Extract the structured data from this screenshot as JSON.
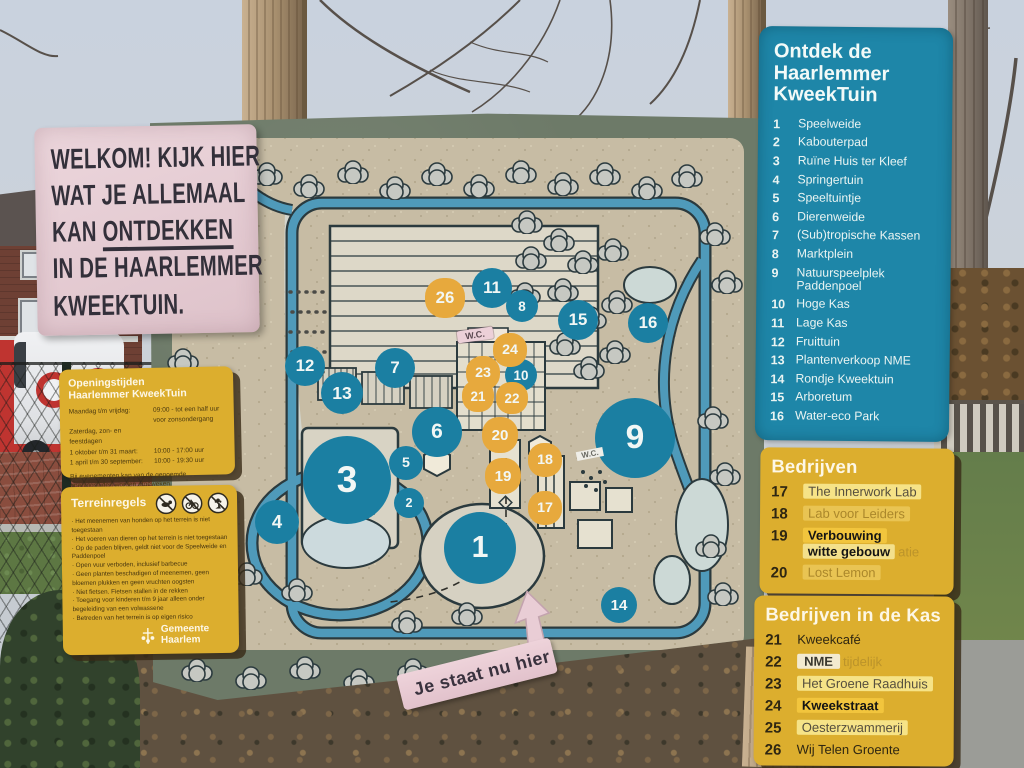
{
  "colors": {
    "sky": "#c9d2de",
    "board": "#6d7a68",
    "map_beige": "#c7bca4",
    "canal": "#4f9aba",
    "marker_blue": "#1b7fa2",
    "marker_yellow": "#e7a93d",
    "panel_blue": "#1e86a8",
    "panel_yellow": "#dcae2e",
    "sign_pink": "#e6ccd3",
    "wood": "#a8906f",
    "grass": "#5d7743",
    "path": "#9b9c97",
    "ground": "#5f5140",
    "brick_road": "#8a4d3e",
    "hedge": "#6b5132",
    "van_red": "#bf3430"
  },
  "welcome_sign": {
    "line1": "WELKOM! KIJK HIER",
    "line2": "WAT JE ALLEMAAL",
    "line3_prefix": "KAN ",
    "line3_underlined": "ONTDEKKEN",
    "line4": "IN DE HAARLEMMER",
    "line5": "KWEEKTUIN."
  },
  "opening_panel": {
    "title_line1": "Openingstijden",
    "title_line2": "Haarlemmer KweekTuin",
    "rows": [
      {
        "label": "Maandag t/m vrijdag:",
        "value": "09:00 - tot een half uur voor zonsondergang"
      },
      {
        "label": "Zaterdag, zon- en feestdagen",
        "value": ""
      },
      {
        "label": "1 oktober t/m 31 maart:",
        "value": "10:00 - 17:00 uur"
      },
      {
        "label": "1 april t/m 30 september:",
        "value": "10:00 - 19:30 uur"
      }
    ],
    "footnote": "Bij evenementen kan van de genoemde openingstijden worden afgeweken."
  },
  "rules_panel": {
    "title": "Terreinregels",
    "rules": [
      "Het meenemen van honden op het terrein is niet toegestaan",
      "Het voeren van dieren op het terrein is niet toegestaan",
      "Op de paden blijven, geldt niet voor de Speelweide en Paddenpoel",
      "Open vuur verboden, inclusief barbecue",
      "Geen planten beschadigen of meenemen, geen bloemen plukken en geen vruchten oogsten",
      "Niet fietsen. Fietsen stallen in de rekken",
      "Toegang voor kinderen t/m 9 jaar alleen onder begeleiding van een volwassene",
      "Betreden van het terrein is op eigen risico"
    ],
    "logo_text": "Gemeente Haarlem"
  },
  "legend_panel": {
    "title_line1": "Ontdek de",
    "title_line2": "Haarlemmer",
    "title_line3": "KweekTuin",
    "items": [
      {
        "num": "1",
        "label": "Speelweide"
      },
      {
        "num": "2",
        "label": "Kabouterpad"
      },
      {
        "num": "3",
        "label": "Ruïne Huis ter Kleef"
      },
      {
        "num": "4",
        "label": "Springertuin"
      },
      {
        "num": "5",
        "label": "Speeltuintje"
      },
      {
        "num": "6",
        "label": "Dierenweide"
      },
      {
        "num": "7",
        "label": "(Sub)tropische Kassen"
      },
      {
        "num": "8",
        "label": "Marktplein"
      },
      {
        "num": "9",
        "label": "Natuurspeelplek Paddenpoel"
      },
      {
        "num": "10",
        "label": "Hoge Kas"
      },
      {
        "num": "11",
        "label": "Lage Kas"
      },
      {
        "num": "12",
        "label": "Fruittuin"
      },
      {
        "num": "13",
        "label": "Plantenverkoop NME"
      },
      {
        "num": "14",
        "label": "Rondje Kweektuin"
      },
      {
        "num": "15",
        "label": "Arboretum"
      },
      {
        "num": "16",
        "label": "Water-eco Park"
      }
    ]
  },
  "bedrijven_panel": {
    "title": "Bedrijven",
    "items": [
      {
        "num": "17",
        "label": "The Innerwork Lab",
        "style": "sticker"
      },
      {
        "num": "18",
        "label": "Lab voor Leiders",
        "style": "faded"
      },
      {
        "num": "19",
        "label": "Verbouwing",
        "label2": "witte gebouw",
        "ghost2": "atie",
        "style": "sticker-dark"
      },
      {
        "num": "20",
        "label": "Lost Lemon",
        "style": "faded"
      }
    ]
  },
  "kas_panel": {
    "title": "Bedrijven in de Kas",
    "items": [
      {
        "num": "21",
        "label": "Kweekcafé",
        "style": "plain"
      },
      {
        "num": "22",
        "label": "NME",
        "ghost": "tijdelijk",
        "style": "sticker-white"
      },
      {
        "num": "23",
        "label": "Het Groene Raadhuis",
        "style": "sticker"
      },
      {
        "num": "24",
        "label": "Kweekstraat",
        "style": "sticker-dark"
      },
      {
        "num": "25",
        "label": "Oesterzwammerij",
        "style": "sticker"
      },
      {
        "num": "26",
        "label": "Wij Telen Groente",
        "style": "plain"
      }
    ]
  },
  "map": {
    "you_are_here": "Je staat nu hier",
    "labels": [
      {
        "text": "W.C.",
        "x": 325,
        "y": 225,
        "style": "ribbon"
      },
      {
        "text": "W.C.",
        "x": 440,
        "y": 344,
        "style": "tag"
      }
    ],
    "markers": [
      {
        "num": "1",
        "color": "blue",
        "x": 330,
        "y": 438,
        "size": 72
      },
      {
        "num": "2",
        "color": "blue",
        "x": 259,
        "y": 393,
        "size": 30
      },
      {
        "num": "3",
        "color": "blue",
        "x": 197,
        "y": 370,
        "size": 88
      },
      {
        "num": "4",
        "color": "blue",
        "x": 127,
        "y": 412,
        "size": 44
      },
      {
        "num": "5",
        "color": "blue",
        "x": 256,
        "y": 353,
        "size": 34
      },
      {
        "num": "6",
        "color": "blue",
        "x": 287,
        "y": 322,
        "size": 50
      },
      {
        "num": "7",
        "color": "blue",
        "x": 245,
        "y": 258,
        "size": 40
      },
      {
        "num": "8",
        "color": "blue",
        "x": 372,
        "y": 196,
        "size": 32
      },
      {
        "num": "9",
        "color": "blue",
        "x": 485,
        "y": 328,
        "size": 80
      },
      {
        "num": "10",
        "color": "blue",
        "x": 371,
        "y": 265,
        "size": 32
      },
      {
        "num": "11",
        "color": "blue",
        "x": 342,
        "y": 178,
        "size": 40
      },
      {
        "num": "12",
        "color": "blue",
        "x": 155,
        "y": 256,
        "size": 40
      },
      {
        "num": "13",
        "color": "blue",
        "x": 192,
        "y": 283,
        "size": 42
      },
      {
        "num": "14",
        "color": "blue",
        "x": 469,
        "y": 495,
        "size": 36
      },
      {
        "num": "15",
        "color": "blue",
        "x": 428,
        "y": 210,
        "size": 40
      },
      {
        "num": "16",
        "color": "blue",
        "x": 498,
        "y": 213,
        "size": 40
      },
      {
        "num": "17",
        "color": "yellow",
        "x": 395,
        "y": 398,
        "size": 34
      },
      {
        "num": "18",
        "color": "yellow",
        "x": 395,
        "y": 350,
        "size": 34
      },
      {
        "num": "19",
        "color": "yellow",
        "x": 353,
        "y": 366,
        "size": 36
      },
      {
        "num": "20",
        "color": "yellow",
        "x": 350,
        "y": 325,
        "size": 36
      },
      {
        "num": "21",
        "color": "yellow",
        "x": 328,
        "y": 286,
        "size": 32
      },
      {
        "num": "22",
        "color": "yellow",
        "x": 362,
        "y": 288,
        "size": 32
      },
      {
        "num": "23",
        "color": "yellow",
        "x": 333,
        "y": 263,
        "size": 34
      },
      {
        "num": "24",
        "color": "yellow",
        "x": 360,
        "y": 240,
        "size": 34
      },
      {
        "num": "26",
        "color": "yellow",
        "x": 295,
        "y": 188,
        "size": 40
      }
    ]
  }
}
